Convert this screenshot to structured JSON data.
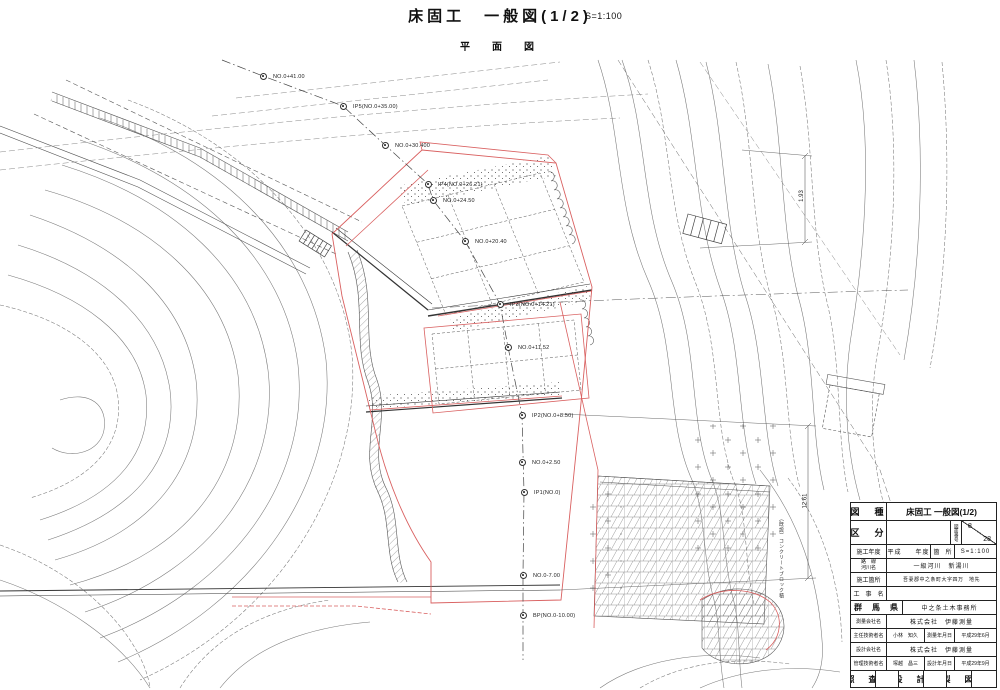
{
  "header": {
    "title": "床固工　一般図(1/2)",
    "scale": "S=1:100",
    "subtitle": "平　面　図"
  },
  "drawing": {
    "stations": [
      "NO.0+41.00",
      "IP5(NO.0+35.00)",
      "NO.0+30.400",
      "IP4(NO.0+26.21)",
      "NO.0+24.50",
      "NO.0+20.40",
      "IP3(NO.0+14.21)",
      "NO.0+11.52",
      "IP2(NO.0+8.50)",
      "NO.0+2.50",
      "IP1(NO.0)",
      "NO.0-7.00",
      "BP(NO.0-10.00)"
    ],
    "dimensions": [
      "1.93",
      "12.61"
    ],
    "annotations": [
      "（既設）コンクリートブロック積"
    ]
  },
  "title_block": {
    "drawing_type_label": "図　種",
    "drawing_type": "床固工 一般図(1/2)",
    "category_label": "区　分",
    "drawing_number_label": "図面番号",
    "drawing_number": "8",
    "drawing_total": "28",
    "fiscal_year_label": "施工年度",
    "fiscal_year_value": "平成　　年度",
    "location_label": "箇　所",
    "scale": "S=1:100",
    "route_label_1": "路　線",
    "route_label_2": "河川名",
    "route_value": "一級河川　新湯川",
    "site_label": "施工箇所",
    "site_value": "吾妻郡中之条町大字四万　地先",
    "project_label": "工　事　名",
    "project_value": "",
    "prefecture": "群　馬　県",
    "office": "中之条土木事務所",
    "survey_company_label": "測量会社名",
    "survey_company": "株式会社　伊藤測量",
    "chief_engineer_label": "主任技術者名",
    "chief_engineer": "小林　知久",
    "survey_date_label": "測量年月日",
    "survey_date": "平成29年6月",
    "design_company_label": "設計会社名",
    "design_company": "株式会社　伊藤測量",
    "manager_label": "管理技術者名",
    "manager": "塚越　昌三",
    "design_date_label": "設計年月日",
    "design_date": "平成29年9月",
    "check_label": "照　査",
    "design_label": "設　計",
    "draft_label": "製　図"
  }
}
